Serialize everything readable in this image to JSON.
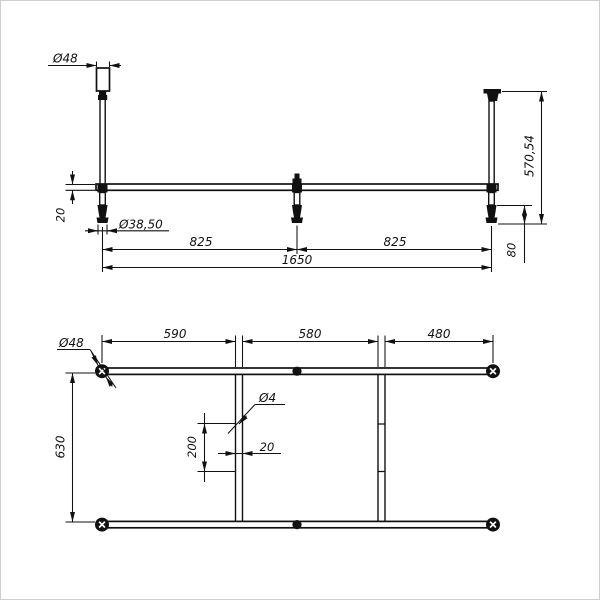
{
  "drawing": {
    "type": "technical-2-view-frame-drawing",
    "front_view": {
      "cap_diameter": "Ø48",
      "tube_diameter": "20",
      "foot_diameter": "Ø38,50",
      "span_left": "825",
      "span_right": "825",
      "total_length": "1650",
      "total_height": "570,54",
      "foot_height": "80"
    },
    "plan_view": {
      "segment_left": "590",
      "segment_middle": "580",
      "segment_right": "480",
      "post_diameter": "Ø48",
      "hole_diameter": "Ø4",
      "hole_spacing": "200",
      "crossbar_width": "20",
      "frame_width": "630"
    },
    "colors": {
      "line": "#111111",
      "background": "#ffffff",
      "border": "#cfcfcf"
    }
  }
}
